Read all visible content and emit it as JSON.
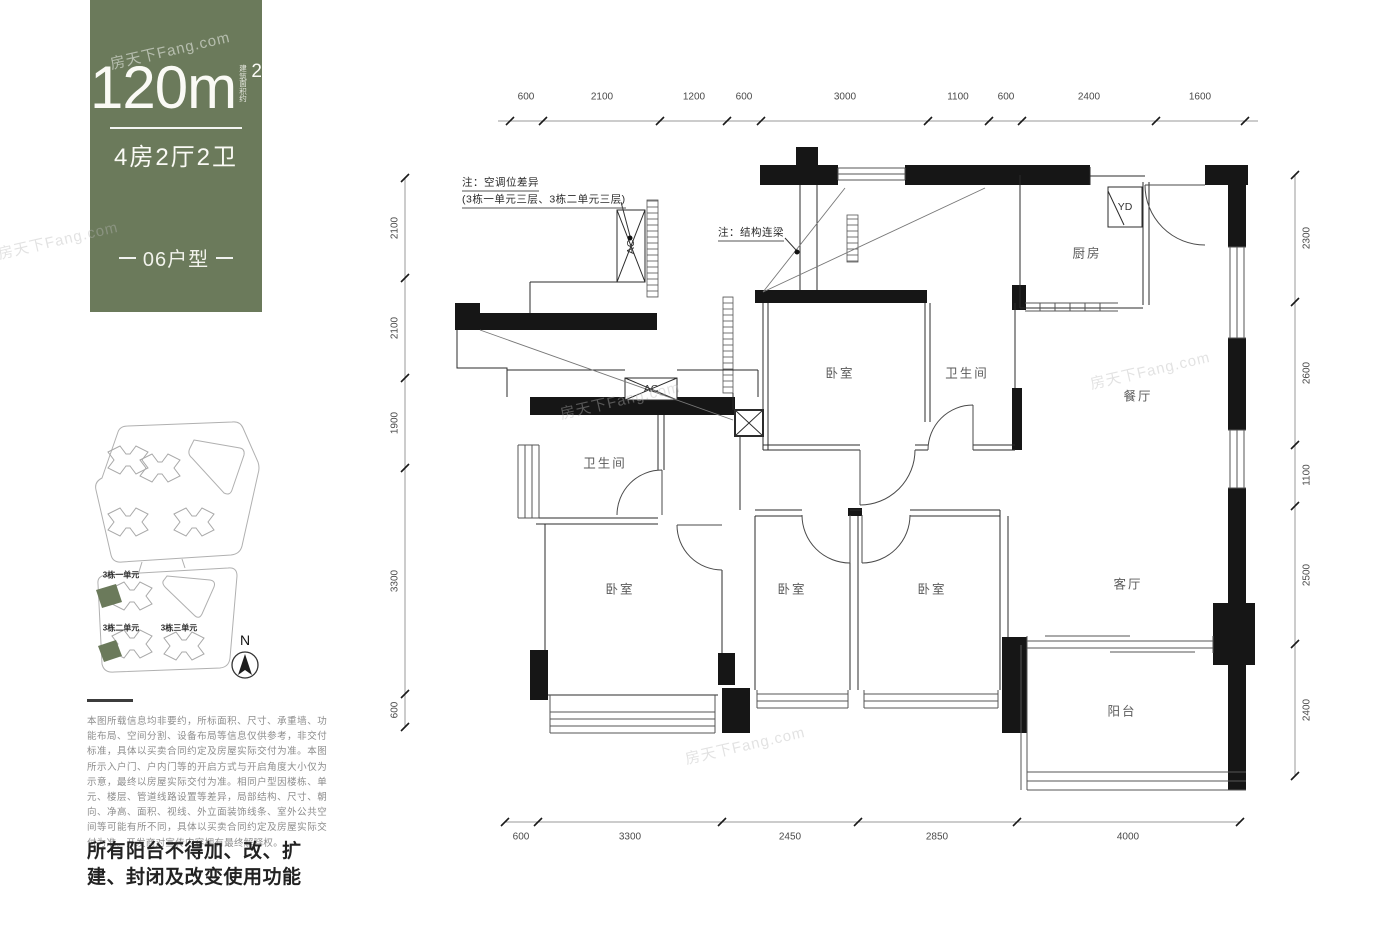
{
  "panel": {
    "area_value": "120m",
    "area_sup": "2",
    "area_note": "建筑面积约",
    "layout_label": "4房2厅2卫",
    "unit_label": "06户型",
    "bg_color": "#6b7a5b"
  },
  "disclaimer": "本图所载信息均非要约，所标面积、尺寸、承重墙、功能布局、空间分割、设备布局等信息仅供参考，非交付标准，具体以买卖合同约定及房屋实际交付为准。本图所示入户门、户内门等的开启方式与开启角度大小仅为示意，最终以房屋实际交付为准。相同户型因楼栋、单元、楼层、管道线路设置等差异，局部结构、尺寸、朝向、净高、面积、视线、外立面装饰线条、室外公共空间等可能有所不同，具体以买卖合同约定及房屋实际交付为准。开发商对宣传内容拥有最终解释权。",
  "notice": "所有阳台不得加、改、扩建、封闭及改变使用功能",
  "floor_plan": {
    "dimensions": {
      "top": [
        "600",
        "2100",
        "1200",
        "600",
        "3000",
        "1100",
        "600",
        "2400",
        "1600"
      ],
      "left": [
        "2100",
        "2100",
        "1900",
        "3300",
        "600"
      ],
      "right": [
        "2300",
        "2600",
        "1100",
        "2500",
        "2400"
      ],
      "bottom": [
        "600",
        "3300",
        "2450",
        "2850",
        "4000"
      ]
    },
    "rooms": [
      "卧室",
      "卫生间",
      "厨房",
      "餐厅",
      "卫生间",
      "卧室",
      "卧室",
      "卧室",
      "客厅",
      "阳台"
    ],
    "equipment": [
      "AC",
      "AC",
      "YD"
    ],
    "notes": [
      "注：空调位差异",
      "(3栋一单元三层、3栋二单元三层)",
      "注：结构连梁"
    ]
  },
  "site_plan": {
    "unit_labels": [
      "3栋一单元",
      "3栋二单元",
      "3栋三单元"
    ],
    "north_label": "N",
    "highlight_color": "#6b7a5b"
  },
  "watermark_text": "房天下Fang.com",
  "annotations": [
    {
      "name": "dim-top-600a",
      "cls": "dim",
      "text": "600",
      "x": 526,
      "y": 97
    },
    {
      "name": "dim-top-2100",
      "cls": "dim",
      "text": "2100",
      "x": 602,
      "y": 97
    },
    {
      "name": "dim-top-1200",
      "cls": "dim",
      "text": "1200",
      "x": 694,
      "y": 97
    },
    {
      "name": "dim-top-600b",
      "cls": "dim",
      "text": "600",
      "x": 744,
      "y": 97
    },
    {
      "name": "dim-top-3000",
      "cls": "dim",
      "text": "3000",
      "x": 845,
      "y": 97
    },
    {
      "name": "dim-top-1100",
      "cls": "dim",
      "text": "1100",
      "x": 958,
      "y": 97
    },
    {
      "name": "dim-top-600c",
      "cls": "dim",
      "text": "600",
      "x": 1006,
      "y": 97
    },
    {
      "name": "dim-top-2400",
      "cls": "dim",
      "text": "2400",
      "x": 1089,
      "y": 97
    },
    {
      "name": "dim-top-1600",
      "cls": "dim",
      "text": "1600",
      "x": 1200,
      "y": 97
    },
    {
      "name": "dim-left-2100a",
      "cls": "dimv",
      "text": "2100",
      "x": 395,
      "y": 228
    },
    {
      "name": "dim-left-2100b",
      "cls": "dimv",
      "text": "2100",
      "x": 395,
      "y": 328
    },
    {
      "name": "dim-left-1900",
      "cls": "dimv",
      "text": "1900",
      "x": 395,
      "y": 423
    },
    {
      "name": "dim-left-3300",
      "cls": "dimv",
      "text": "3300",
      "x": 395,
      "y": 581
    },
    {
      "name": "dim-left-600",
      "cls": "dimv",
      "text": "600",
      "x": 395,
      "y": 710
    },
    {
      "name": "dim-right-2300",
      "cls": "dimv",
      "text": "2300",
      "x": 1307,
      "y": 238
    },
    {
      "name": "dim-right-2600",
      "cls": "dimv",
      "text": "2600",
      "x": 1307,
      "y": 373
    },
    {
      "name": "dim-right-1100",
      "cls": "dimv",
      "text": "1100",
      "x": 1307,
      "y": 475
    },
    {
      "name": "dim-right-2500",
      "cls": "dimv",
      "text": "2500",
      "x": 1307,
      "y": 575
    },
    {
      "name": "dim-right-2400",
      "cls": "dimv",
      "text": "2400",
      "x": 1307,
      "y": 710
    },
    {
      "name": "dim-bottom-600",
      "cls": "dim",
      "text": "600",
      "x": 521,
      "y": 837
    },
    {
      "name": "dim-bottom-3300",
      "cls": "dim",
      "text": "3300",
      "x": 630,
      "y": 837
    },
    {
      "name": "dim-bottom-2450",
      "cls": "dim",
      "text": "2450",
      "x": 790,
      "y": 837
    },
    {
      "name": "dim-bottom-2850",
      "cls": "dim",
      "text": "2850",
      "x": 937,
      "y": 837
    },
    {
      "name": "dim-bottom-4000",
      "cls": "dim",
      "text": "4000",
      "x": 1128,
      "y": 837
    },
    {
      "name": "room-bedroom-1",
      "cls": "room",
      "text": "卧室",
      "x": 840,
      "y": 372
    },
    {
      "name": "room-bathroom-1",
      "cls": "room",
      "text": "卫生间",
      "x": 967,
      "y": 372
    },
    {
      "name": "room-kitchen",
      "cls": "room",
      "text": "厨房",
      "x": 1087,
      "y": 252
    },
    {
      "name": "room-dining",
      "cls": "room",
      "text": "餐厅",
      "x": 1138,
      "y": 395
    },
    {
      "name": "room-bathroom-2",
      "cls": "room",
      "text": "卫生间",
      "x": 605,
      "y": 462
    },
    {
      "name": "room-bedroom-2",
      "cls": "room",
      "text": "卧室",
      "x": 620,
      "y": 588
    },
    {
      "name": "room-bedroom-3",
      "cls": "room",
      "text": "卧室",
      "x": 792,
      "y": 588
    },
    {
      "name": "room-bedroom-4",
      "cls": "room",
      "text": "卧室",
      "x": 932,
      "y": 588
    },
    {
      "name": "room-living",
      "cls": "room",
      "text": "客厅",
      "x": 1128,
      "y": 583
    },
    {
      "name": "room-balcony",
      "cls": "room",
      "text": "阳台",
      "x": 1122,
      "y": 710
    },
    {
      "name": "equip-ac-1",
      "cls": "equipv",
      "text": "AC",
      "x": 631,
      "y": 247
    },
    {
      "name": "equip-ac-2",
      "cls": "equip",
      "text": "AC",
      "x": 651,
      "y": 389
    },
    {
      "name": "equip-yd",
      "cls": "equip",
      "text": "YD",
      "x": 1125,
      "y": 207
    },
    {
      "name": "note-ac-line1",
      "cls": "note",
      "text": "注：空调位差异",
      "x": 462,
      "y": 183
    },
    {
      "name": "note-ac-line2",
      "cls": "note",
      "text": "(3栋一单元三层、3栋二单元三层)",
      "x": 462,
      "y": 200
    },
    {
      "name": "note-beam",
      "cls": "note",
      "text": "注：结构连梁",
      "x": 718,
      "y": 233
    },
    {
      "name": "site-unit-1",
      "cls": "site",
      "text": "3栋一单元",
      "x": 121,
      "y": 575
    },
    {
      "name": "site-unit-2",
      "cls": "site",
      "text": "3栋二单元",
      "x": 121,
      "y": 628
    },
    {
      "name": "site-unit-3",
      "cls": "site",
      "text": "3栋三单元",
      "x": 179,
      "y": 628
    },
    {
      "name": "north-label",
      "cls": "north",
      "text": "N",
      "x": 245,
      "y": 640
    },
    {
      "name": "watermark-1",
      "cls": "wmw",
      "text": "房天下Fang.com",
      "x": 170,
      "y": 50
    },
    {
      "name": "watermark-2",
      "cls": "wm",
      "text": "房天下Fang.com",
      "x": 58,
      "y": 240
    },
    {
      "name": "watermark-3",
      "cls": "wm",
      "text": "房天下Fang.com",
      "x": 620,
      "y": 400
    },
    {
      "name": "watermark-4",
      "cls": "wm",
      "text": "房天下Fang.com",
      "x": 1150,
      "y": 370
    },
    {
      "name": "watermark-5",
      "cls": "wm",
      "text": "房天下Fang.com",
      "x": 745,
      "y": 745
    }
  ]
}
